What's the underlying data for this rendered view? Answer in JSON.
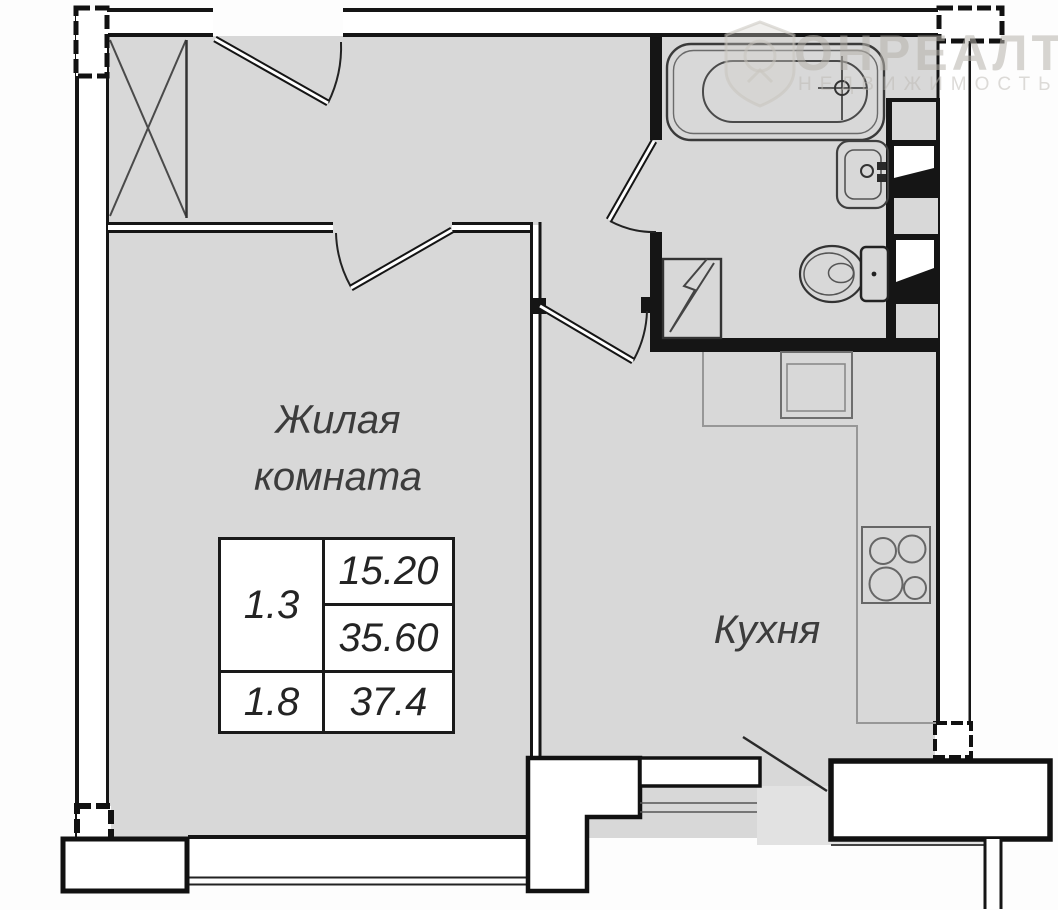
{
  "labels": {
    "living_room_line1": "Жилая",
    "living_room_line2": "комната",
    "kitchen": "Кухня"
  },
  "info_table": {
    "room_number": "1.3",
    "living_area": "15.20",
    "total_area": "35.60",
    "second_number": "1.8",
    "second_area": "37.4"
  },
  "watermark": {
    "brand": "ОНРЕАЛТ",
    "subtitle": "НЕДВИЖИМОСТЬ"
  },
  "colors": {
    "wall": "#151515",
    "floor": "#d8d8d8",
    "balcony_floor": "#e2e2e2",
    "fixture_line": "#3f3f3f",
    "counter_line": "#979797",
    "background": "#fdfdfd",
    "watermark": "#b7b3ab"
  }
}
